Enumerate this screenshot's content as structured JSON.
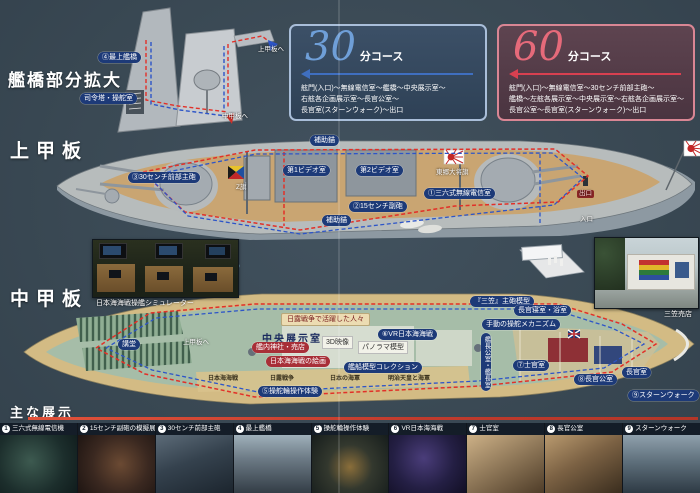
{
  "page": {
    "bridge_title": "艦橋部分拡大",
    "upper_deck_title": "上甲板",
    "middle_deck_title": "中甲板"
  },
  "courses": {
    "c30": {
      "number": "30",
      "unit": "分コース",
      "lines": [
        "舷門(入口)〜無線電信室〜艦橋〜中央展示室〜",
        "右舷各企画展示室〜長官公室〜",
        "長官室(スターンウォーク)〜出口"
      ]
    },
    "c60": {
      "number": "60",
      "unit": "分コース",
      "lines": [
        "舷門(入口)〜無線電信室〜30センチ前部主砲〜",
        "艦橋〜左舷各展示室〜中央展示室〜右舷各企画展示室〜",
        "長官公室〜長官室(スターンウォーク)〜出口"
      ]
    }
  },
  "bridge_inset": {
    "labels": [
      {
        "text": "④最上艦橋"
      },
      {
        "text": "司令塔・操舵室"
      },
      {
        "text": "中甲板へ"
      },
      {
        "text": "上甲板へ"
      }
    ]
  },
  "upper_deck": {
    "labels": [
      {
        "text": "③30センチ前部主砲"
      },
      {
        "text": "第1ビデオ室"
      },
      {
        "text": "第2ビデオ室"
      },
      {
        "text": "補助錨"
      },
      {
        "text": "補助錨"
      },
      {
        "text": "①三六式無線電信室"
      },
      {
        "text": "東郷大将旗"
      },
      {
        "text": "出口"
      },
      {
        "text": "入口"
      },
      {
        "text": "Z旗"
      },
      {
        "text": "②15センチ副砲"
      }
    ]
  },
  "middle_deck": {
    "labels": [
      {
        "text": "講堂"
      },
      {
        "text": "中央展示室"
      },
      {
        "text": "日露戦争で活躍した人々"
      },
      {
        "text": "⑥VR日本海海戦"
      },
      {
        "text": "パノラマ模型"
      },
      {
        "text": "3D映像"
      },
      {
        "text": "艦内神社・売店"
      },
      {
        "text": "日本海海戦の絵画"
      },
      {
        "text": "艦船模型コレクション"
      },
      {
        "text": "日本海海戦"
      },
      {
        "text": "日露戦争"
      },
      {
        "text": "日本の海軍"
      },
      {
        "text": "明治天皇と海軍"
      },
      {
        "text": "⑤操舵輪操作体験"
      },
      {
        "text": "『三笠』主砲模型"
      },
      {
        "text": "長官寝室・浴室"
      },
      {
        "text": "手動の操舵メカニズム"
      },
      {
        "text": "⑦士官室"
      },
      {
        "text": "⑧長官公室"
      },
      {
        "text": "長官室"
      },
      {
        "text": "⑨スターンウォーク"
      },
      {
        "text": "艦長公室・艦長室"
      },
      {
        "text": "上甲板へ"
      }
    ]
  },
  "captions": {
    "simulator": "日本海海戦操艦シミュレーター",
    "shop": "三笠売店"
  },
  "legend": {
    "title": "主な展示",
    "items": [
      {
        "num": "1",
        "label": "三六式無線電信機"
      },
      {
        "num": "2",
        "label": "15センチ副砲の模擬展示"
      },
      {
        "num": "3",
        "label": "30センチ前部主砲"
      },
      {
        "num": "4",
        "label": "最上艦橋"
      },
      {
        "num": "5",
        "label": "操舵輪操作体験"
      },
      {
        "num": "6",
        "label": "VR日本海海戦"
      },
      {
        "num": "7",
        "label": "士官室"
      },
      {
        "num": "8",
        "label": "長官公室"
      },
      {
        "num": "9",
        "label": "スターンウォーク"
      }
    ]
  },
  "colors": {
    "course30_accent": "#5d8ed2",
    "course60_accent": "#e4606f",
    "route_red": "#e23028",
    "route_blue": "#2d55c8",
    "pill_navy": "#1d3a78",
    "pill_red": "#a82f38"
  }
}
